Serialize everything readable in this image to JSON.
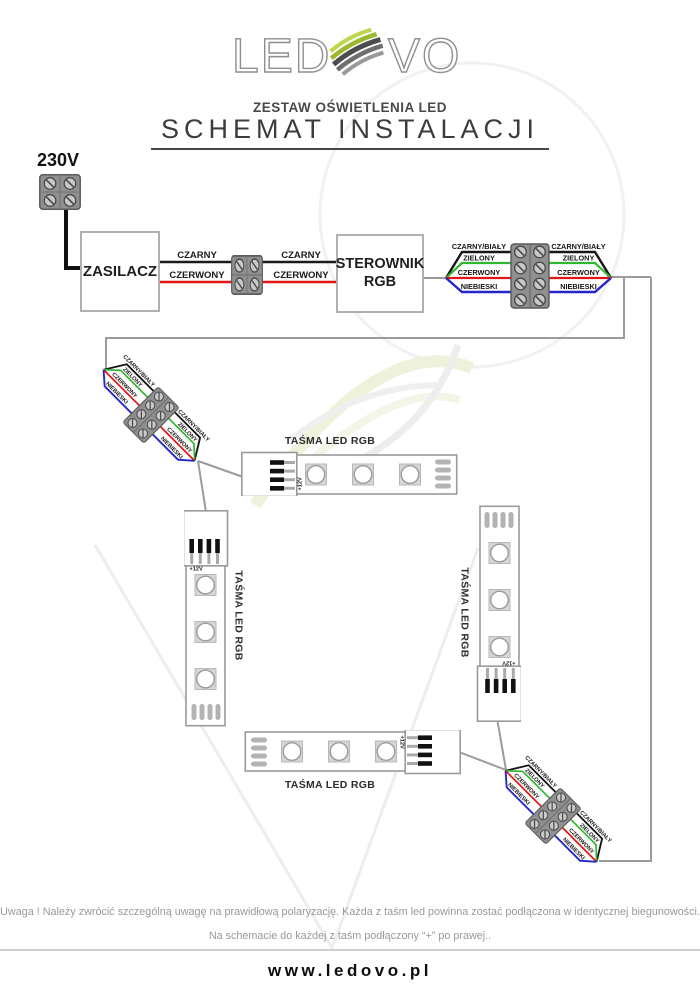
{
  "header": {
    "logo_left": "LED",
    "logo_right": "VO",
    "subtitle": "ZESTAW OŚWIETLENIA LED",
    "title": "SCHEMAT INSTALACJI"
  },
  "diagram": {
    "mains_voltage": "230V",
    "power_supply": "ZASILACZ",
    "controller_line1": "STEROWNIK",
    "controller_line2": "RGB",
    "wire_black_label": "CZARNY",
    "wire_red_label": "CZERWONY",
    "rgb_wire_labels": [
      "CZARNY/BIAŁY",
      "ZIELONY",
      "CZERWONY",
      "NIEBIESKI"
    ],
    "strip_label": "TAŚMA LED RGB",
    "strip_plus_label": "+12V",
    "colors": {
      "black_wire": "#1a1a1a",
      "red_wire": "#e31414",
      "green_wire": "#2eb82e",
      "blue_wire": "#2525cc",
      "gray_wire": "#9b9b9b",
      "logo_green": "#a3c130"
    }
  },
  "notes": {
    "line1": "Uwaga ! Należy zwrócić szczególną uwagę na prawidłową polaryzację. Każda z taśm led powinna zostać podłączona w identycznej biegunowości.",
    "line2": "Na schemacie do każdej z taśm podłączony “+” po prawej.."
  },
  "footer": {
    "url": "www.ledovo.pl"
  }
}
